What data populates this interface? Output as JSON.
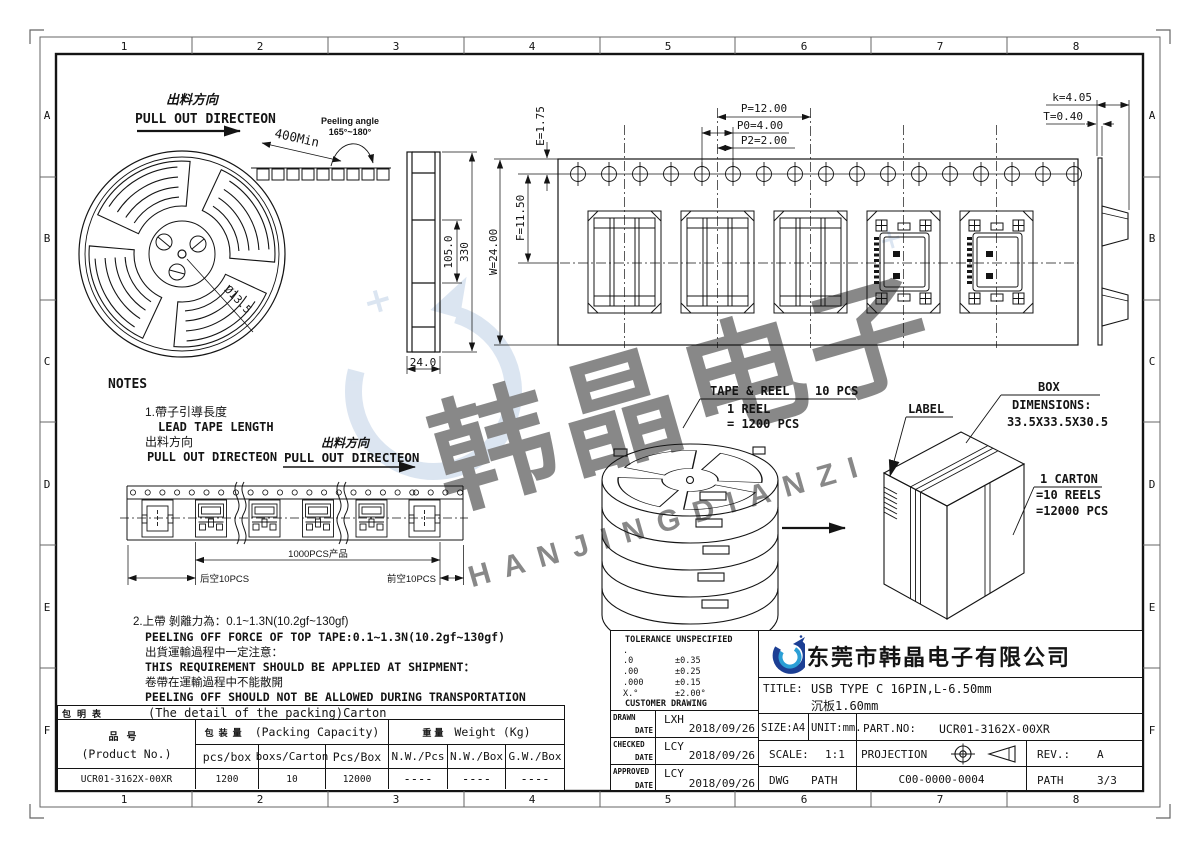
{
  "sheet": {
    "grid_cols": [
      "1",
      "2",
      "3",
      "4",
      "5",
      "6",
      "7",
      "8"
    ],
    "grid_rows": [
      "A",
      "B",
      "C",
      "D",
      "E",
      "F"
    ]
  },
  "watermark": {
    "cn": "韩晶电子",
    "pinyin": "HANJINGDIANZI",
    "color": "#b9cce4"
  },
  "reel": {
    "pull_out_cn": "出料方向",
    "pull_out_en": "PULL OUT DIRECTEON",
    "lead_len": "400Min",
    "peel_angle_label": "Peeling angle",
    "peel_angle_value": "165°~180°",
    "hub_dia": "Ø13.5",
    "dim_inner": "105.0",
    "dim_outer": "330",
    "dim_width": "24.0"
  },
  "tape": {
    "e": "E=1.75",
    "f": "F=11.50",
    "w": "W=24.00",
    "p": "P=12.00",
    "p0": "P0=4.00",
    "p2": "P2=2.00",
    "k": "k=4.05",
    "t": "T=0.40"
  },
  "notes": {
    "title": "NOTES",
    "n1_l1": "1.帶子引導長度",
    "n1_l2": "LEAD TAPE LENGTH",
    "n1_l3": "出料方向",
    "n1_l4": "PULL OUT DIRECTEON",
    "pull2_cn": "出料方向",
    "pull2_en": "PULL OUT DIRECTEON",
    "strip_mid": "1000PCS产品",
    "strip_left": "后空10PCS",
    "strip_right": "前空10PCS",
    "n2_l1": "2.上帶 剝離力為：0.1~1.3N(10.2gf~130gf)",
    "n2_l2": "PEELING OFF FORCE OF TOP TAPE:0.1~1.3N(10.2gf~130gf)",
    "n2_l3": "出貨運輸過程中一定注意：",
    "n2_l4": "THIS REQUIREMENT SHOULD BE APPLIED AT SHIPMENT：",
    "n2_l5": "卷帶在運輸過程中不能散開",
    "n2_l6": "PEELING OFF SHOULD NOT BE ALLOWED DURING TRANSPORTATION"
  },
  "packing": {
    "tape_reel_label": "TAPE & REEL",
    "tape_reel_qty": "10 PCS",
    "reel_l1": "1 REEL",
    "reel_l2": "= 1200 PCS",
    "box_label": "BOX",
    "box_dims_label": "DIMENSIONS:",
    "box_dims": "33.5X33.5X30.5",
    "label_label": "LABEL",
    "carton_l1": "1 CARTON",
    "carton_l2": "=10 REELS",
    "carton_l3": "=12000 PCS"
  },
  "packing_table": {
    "corner": "包明表",
    "caption": "(The detail of the packing)Carton",
    "product_cn": "品号",
    "product_en": "(Product No.)",
    "capacity_cn": "包装量",
    "capacity_en": "(Packing Capacity)",
    "weight_cn": "重量",
    "weight_en": "Weight (Kg)",
    "cols": [
      "pcs/box",
      "boxs/Carton",
      "Pcs/Box",
      "N.W./Pcs",
      "N.W./Box",
      "G.W./Box"
    ],
    "row": {
      "product": "UCR01-3162X-00XR",
      "pcs_box": "1200",
      "boxes_carton": "10",
      "pcs_carton": "12000",
      "nw_pcs": "----",
      "nw_box": "----",
      "gw_box": "----"
    }
  },
  "title_block": {
    "tol_title": "TOLERANCE UNSPECIFIED",
    "tol": [
      {
        "k": ".",
        "v": ""
      },
      {
        "k": ".0",
        "v": "±0.35"
      },
      {
        "k": ".00",
        "v": "±0.25"
      },
      {
        "k": ".000",
        "v": "±0.15"
      },
      {
        "k": "X.°",
        "v": "±2.00°"
      }
    ],
    "customer": "CUSTOMER DRAWING",
    "signs": [
      {
        "role": "DRAWN",
        "dl": "DATE",
        "name": "LXH",
        "date": "2018/09/26"
      },
      {
        "role": "CHECKED",
        "dl": "DATE",
        "name": "LCY",
        "date": "2018/09/26"
      },
      {
        "role": "APPROVED",
        "dl": "DATE",
        "name": "LCY",
        "date": "2018/09/26"
      }
    ],
    "company": "东莞市韩晶电子有限公司",
    "title_label": "TITLE:",
    "title1": "USB TYPE C 16PIN,L-6.50mm",
    "title2": "沉板1.60mm",
    "size": "SIZE:A4",
    "unit": "UNIT:mm.",
    "partno_label": "PART.NO:",
    "partno": "UCR01-3162X-00XR",
    "scale_label": "SCALE:",
    "scale": "1:1",
    "projection": "PROJECTION",
    "rev_label": "REV.:",
    "rev": "A",
    "dwg": "DWG",
    "path": "PATH",
    "dwg_no": "C00-0000-0004",
    "path2": "PATH",
    "page": "3/3"
  }
}
